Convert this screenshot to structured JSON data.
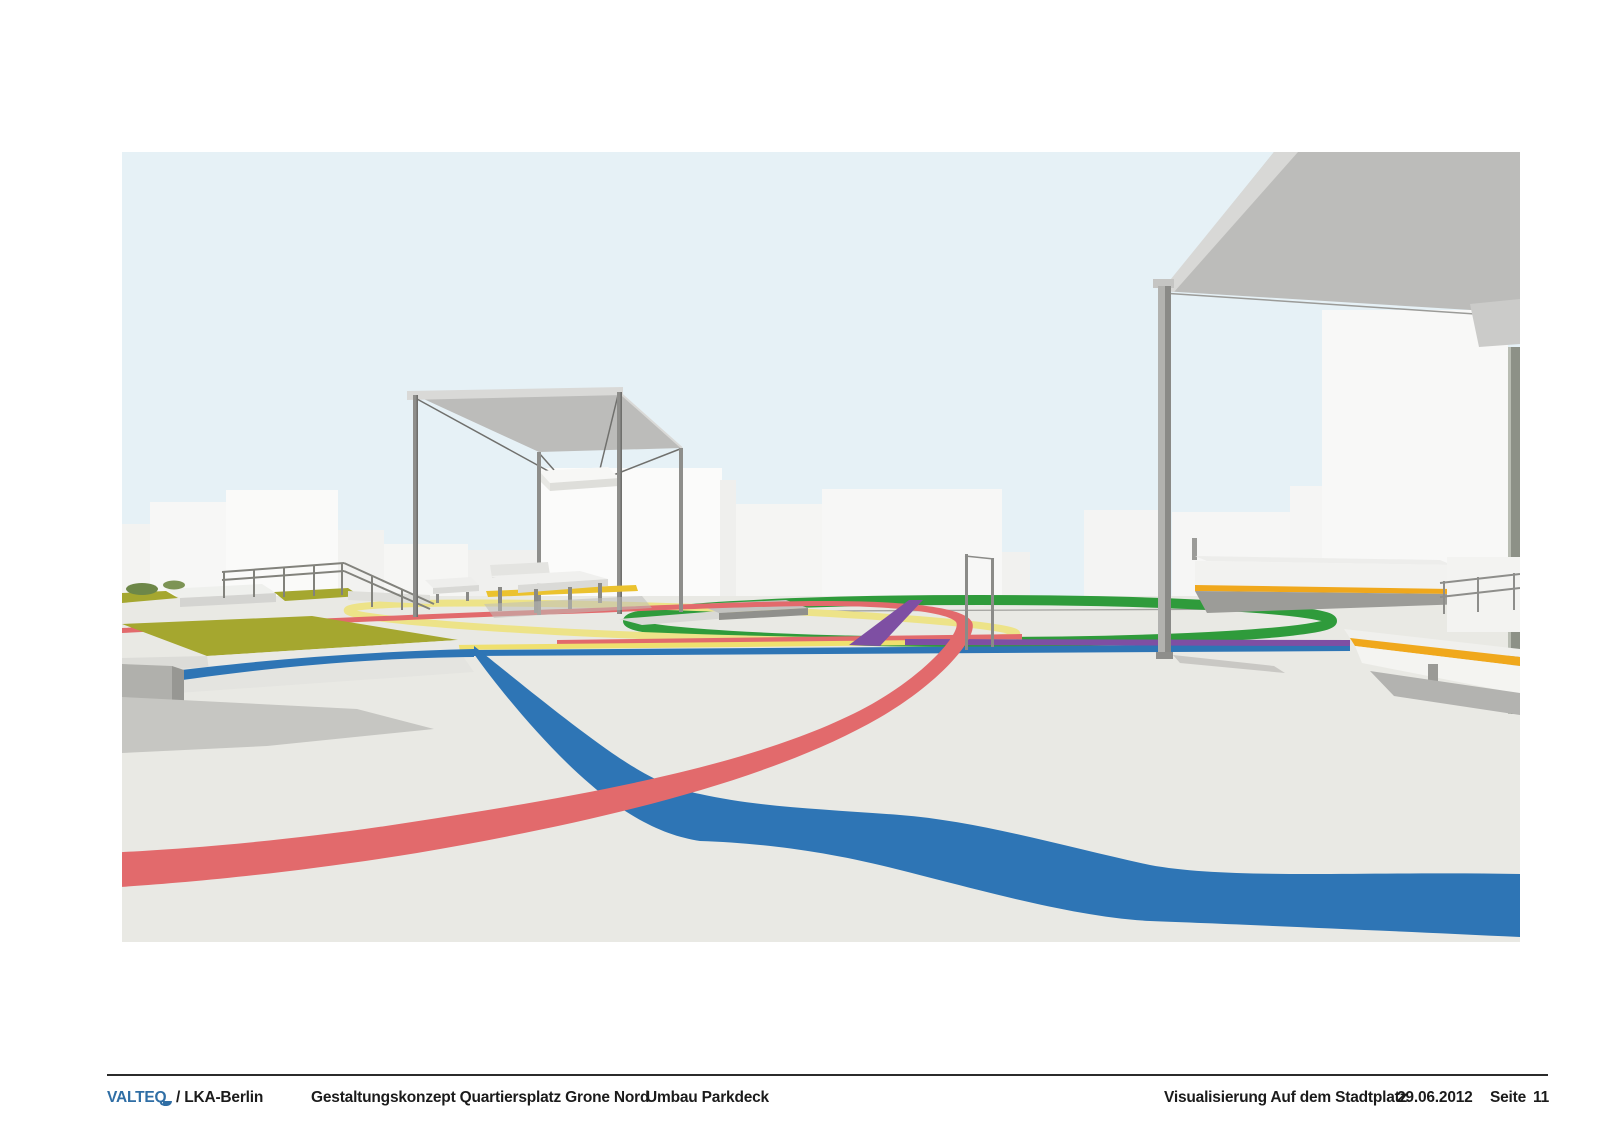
{
  "footer": {
    "logo": "VALTEQ",
    "partner": "/ LKA-Berlin",
    "project_title": "Gestaltungskonzept Quartiersplatz Grone Nord",
    "project_subtitle": "Umbau Parkdeck",
    "sheet_title": "Visualisierung Auf dem Stadtplatz",
    "date": "29.06.2012",
    "page_label": "Seite",
    "page_number": "11"
  },
  "scene": {
    "colors": {
      "sky": "#e6f1f6",
      "ground": "#e9e9e4",
      "track_red": "#e26a6c",
      "track_blue": "#2e75b5",
      "track_green": "#2f9b3b",
      "track_yellow_pale": "#ede388",
      "stripe_yellow": "#efe06e",
      "track_purple": "#7e4fa3",
      "accent_orange": "#f0a81c",
      "bench_stripe_yellow": "#ebc22e",
      "lawn_olive": "#a5a72f",
      "canopy_gray": "#bcbcba",
      "structure_gray": "#8e8e8b",
      "building_white": "#f8f8f7",
      "shadow_gray": "#c6c6c2",
      "logo_blue": "#2f6ea5",
      "footer_text": "#1b1b1b"
    }
  }
}
